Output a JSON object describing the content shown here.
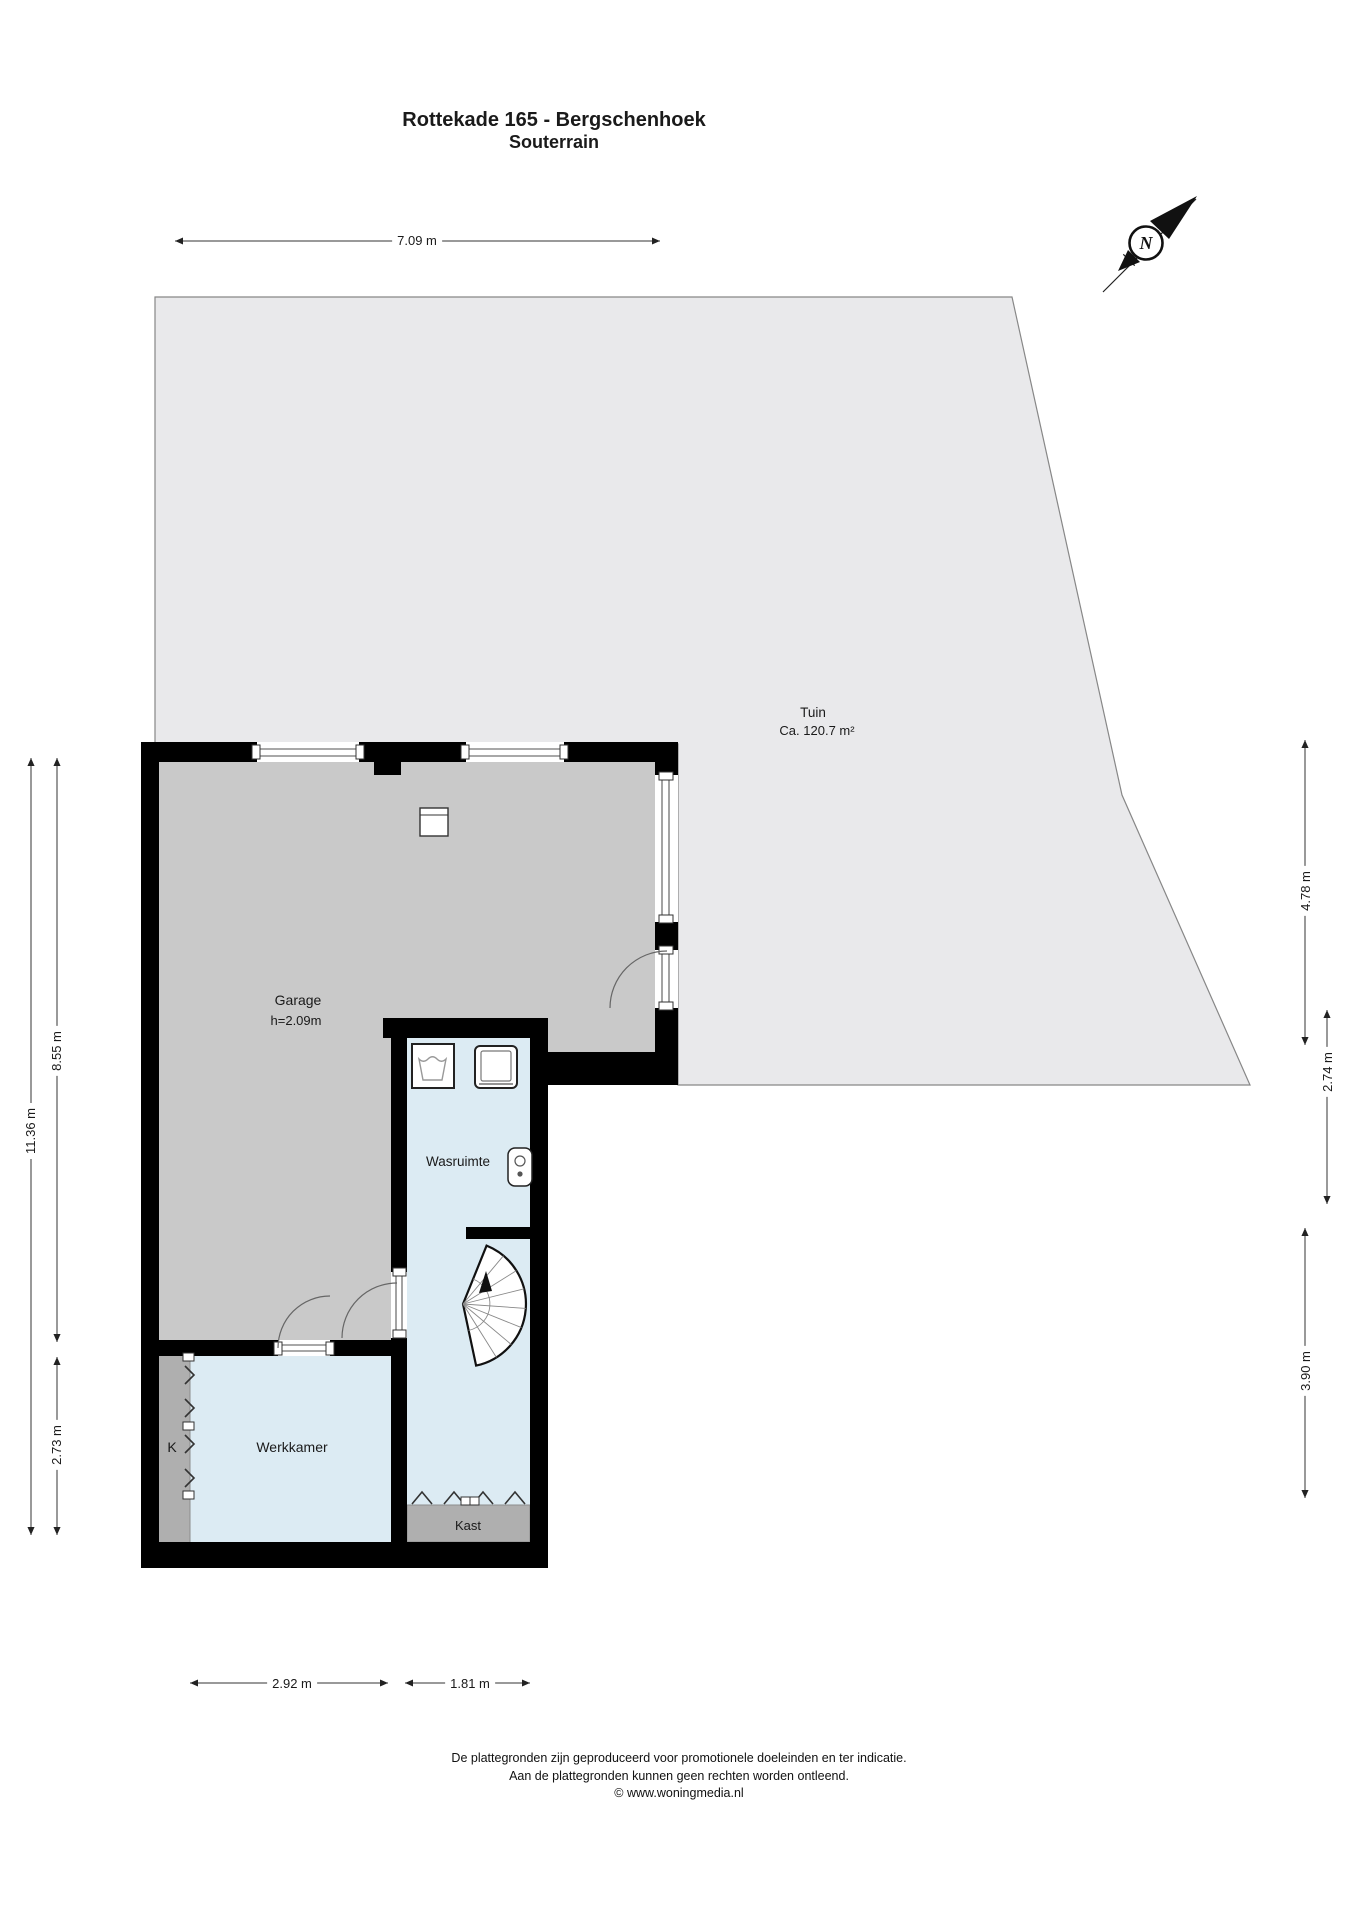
{
  "title": {
    "line1": "Rottekade 165 - Bergschenhoek",
    "line2": "Souterrain"
  },
  "compass": {
    "label": "N"
  },
  "rooms": {
    "tuin": {
      "name": "Tuin",
      "area": "Ca. 120.7 m²"
    },
    "garage": {
      "name": "Garage",
      "height": "h=2.09m"
    },
    "wasruimte": {
      "name": "Wasruimte"
    },
    "werkkamer": {
      "name": "Werkkamer"
    },
    "k": {
      "name": "K"
    },
    "kast": {
      "name": "Kast"
    }
  },
  "dimensions": {
    "top": "7.09 m",
    "left_outer": "11.36 m",
    "left_upper": "8.55 m",
    "left_lower": "2.73 m",
    "right_upper": "4.78 m",
    "right_middle": "2.74 m",
    "right_lower": "3.90 m",
    "bottom_left": "2.92 m",
    "bottom_right": "1.81 m"
  },
  "icons": {
    "compass": "north-arrow-icon",
    "washer": "washing-machine-icon",
    "dryer": "dryer-icon",
    "boiler": "boiler-icon",
    "stairs": "spiral-stairs-icon"
  },
  "colors": {
    "wall": "#000000",
    "tuin_fill": "#e9e9eb",
    "garage_fill": "#c9c9c9",
    "room_fill": "#dcebf3",
    "closet_fill": "#afafaf",
    "window_line": "#8c8c8c",
    "dim_line": "#333333"
  },
  "footer": {
    "line1": "De plattegronden zijn geproduceerd voor promotionele doeleinden en ter indicatie.",
    "line2": "Aan de plattegronden kunnen geen rechten worden ontleend.",
    "line3": "© www.woningmedia.nl"
  }
}
